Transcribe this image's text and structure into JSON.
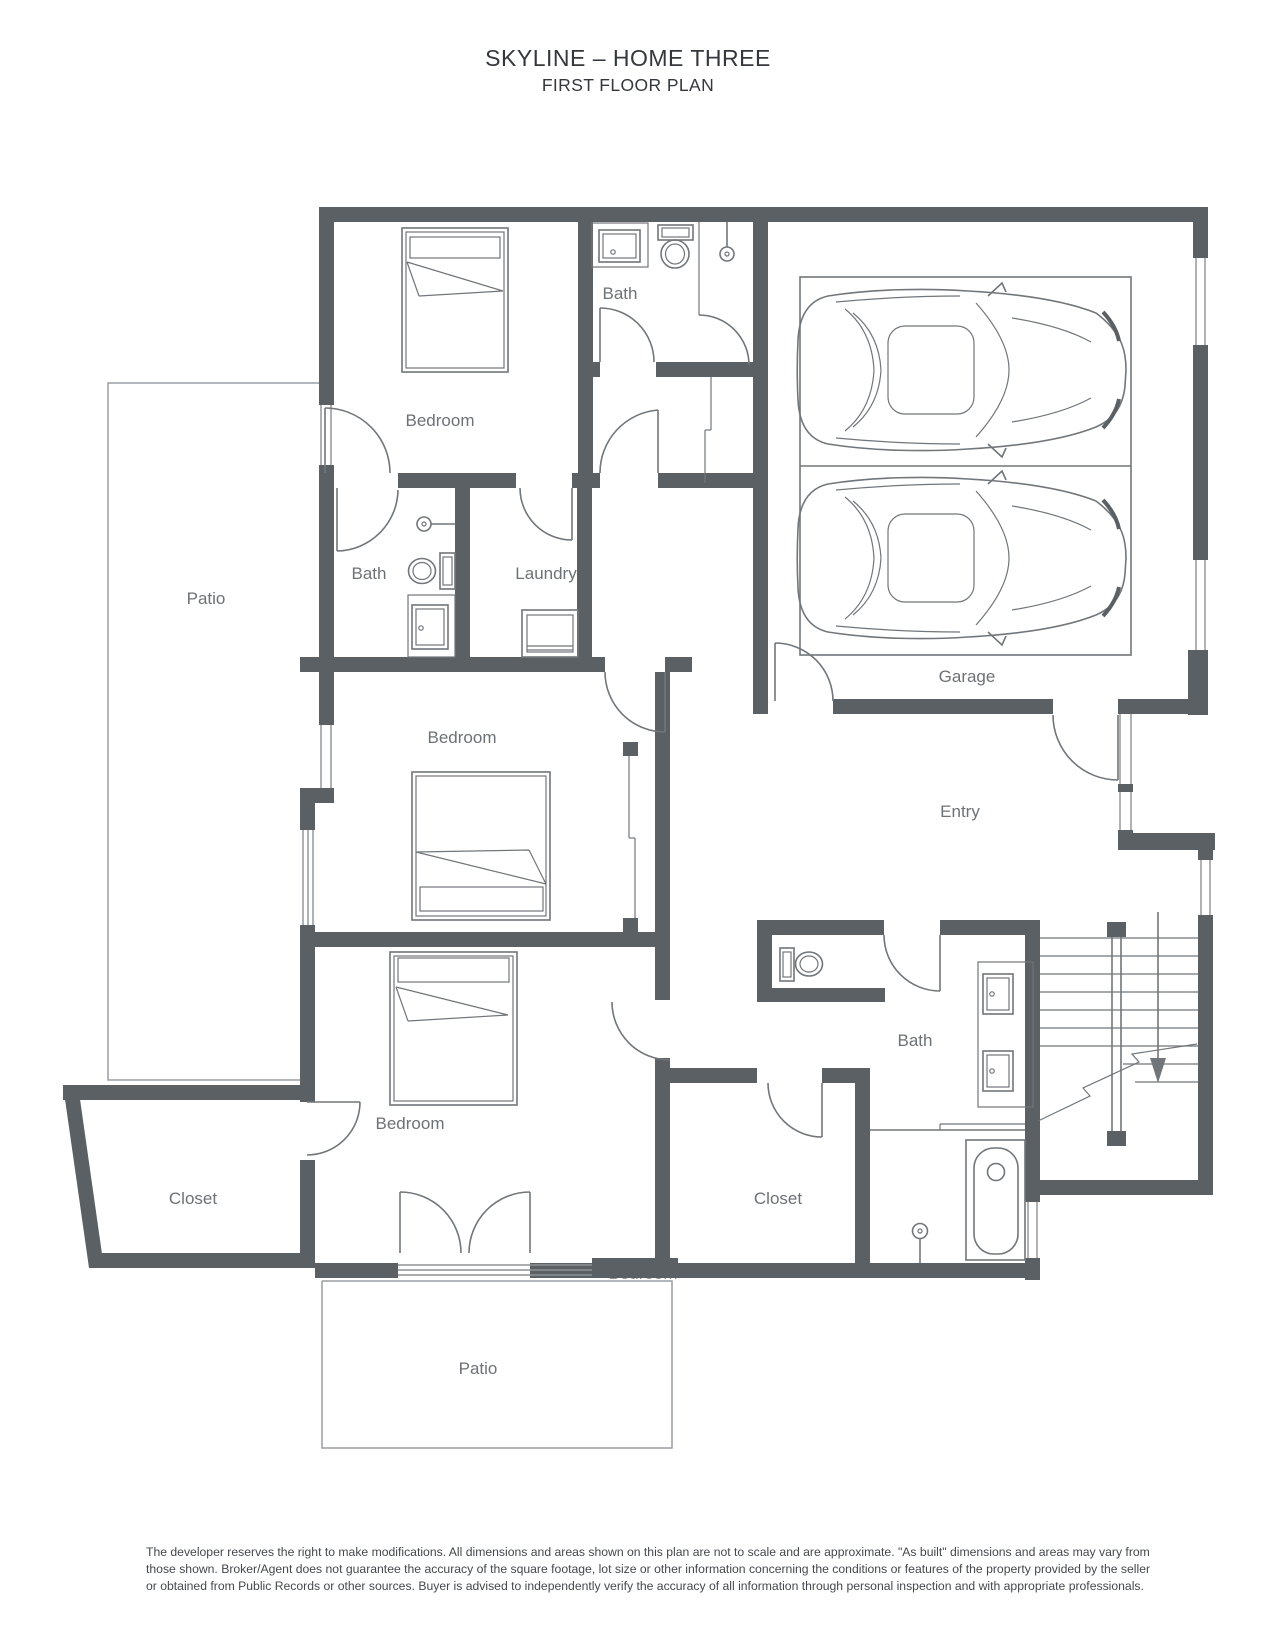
{
  "title": {
    "line1": "SKYLINE – HOME THREE",
    "line2": "FIRST FLOOR PLAN"
  },
  "floor_plan": {
    "labels": {
      "bedroom_top": "Bedroom",
      "bath_top": "Bath",
      "garage": "Garage",
      "bath_middle": "Bath",
      "laundry": "Laundry",
      "bedroom_middle": "Bedroom",
      "entry": "Entry",
      "patio_left": "Patio",
      "bath_lower": "Bath",
      "bedroom_lower": "Bedroom",
      "bedroom_lower_hidden": "Bedroom",
      "closet_left": "Closet",
      "closet_right": "Closet",
      "patio_bottom": "Patio"
    },
    "colors": {
      "wall": "#5b6065",
      "fixture_line": "#71767a",
      "label_text": "#6d7276",
      "patio_outline": "#9a9ea1",
      "title_text": "#34383c",
      "disclaimer_text": "#44484c"
    }
  },
  "disclaimer": {
    "line1": "The developer reserves the right to make modifications. All dimensions and areas shown on this plan are not to scale and are approximate. \"As built\" dimensions and areas may vary from",
    "line2": "those shown. Broker/Agent does not guarantee the accuracy of the square footage, lot size or other information concerning the conditions or features of the property provided by the seller",
    "line3": "or obtained from Public Records or other sources. Buyer is advised to independently verify the accuracy of all information through personal inspection and with appropriate professionals."
  }
}
